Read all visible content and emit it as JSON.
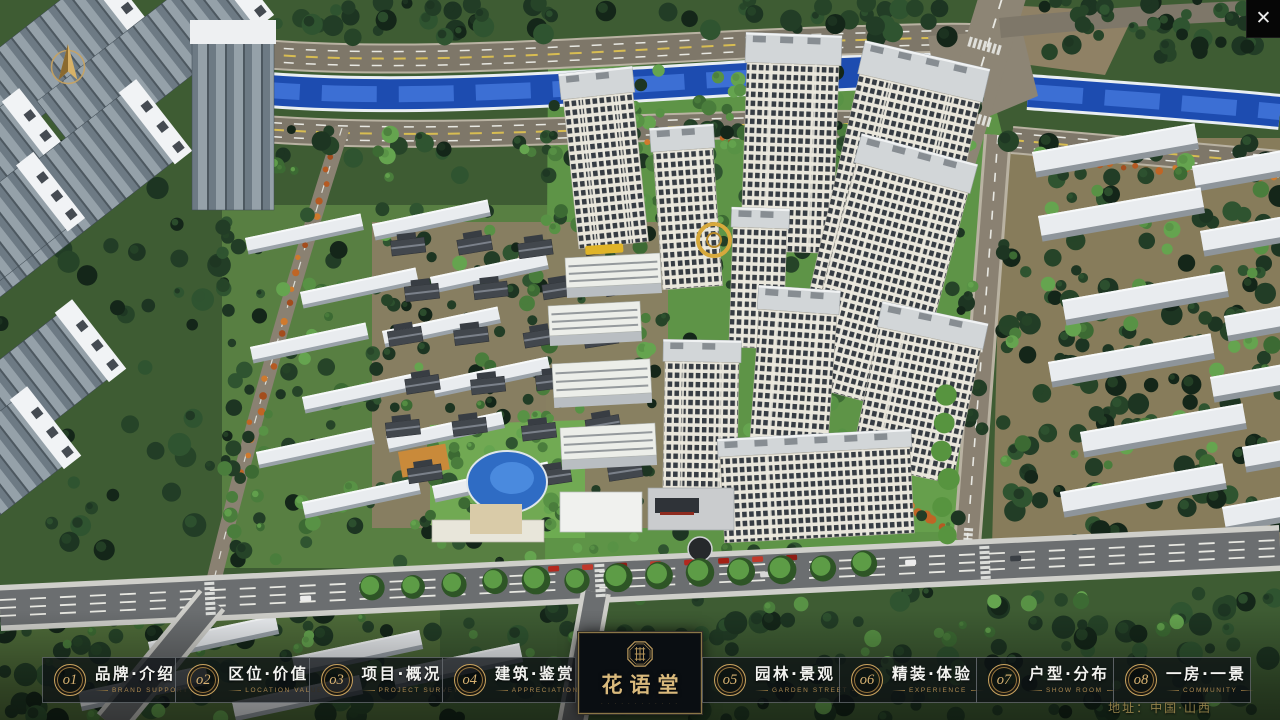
{
  "window": {
    "close_glyph": "✕"
  },
  "menu": {
    "items": [
      {
        "num": "o1",
        "label": "品牌·介绍",
        "sub": "BRAND SUPPORT"
      },
      {
        "num": "o2",
        "label": "区位·价值",
        "sub": "LOCATION VALUE"
      },
      {
        "num": "o3",
        "label": "项目·概况",
        "sub": "PROJECT SURVEY"
      },
      {
        "num": "o4",
        "label": "建筑·鉴赏",
        "sub": "APPRECIATION"
      },
      {
        "num": "o5",
        "label": "园林·景观",
        "sub": "GARDEN STREET"
      },
      {
        "num": "o6",
        "label": "精装·体验",
        "sub": "EXPERIENCE"
      },
      {
        "num": "o7",
        "label": "户型·分布",
        "sub": "SHOW ROOM"
      },
      {
        "num": "o8",
        "label": "一房·一景",
        "sub": "COMMUNITY"
      }
    ]
  },
  "logo": {
    "title": "花语堂",
    "subtitle_marks": "· · · · · · · · · · · ·"
  },
  "footer": {
    "address": "地址：中国·山西"
  },
  "colors": {
    "gold": "#c9a35f",
    "bar_bg": "rgba(12,16,20,0.74)",
    "river": "#1d4cb0",
    "lawn": "#5e9447"
  }
}
